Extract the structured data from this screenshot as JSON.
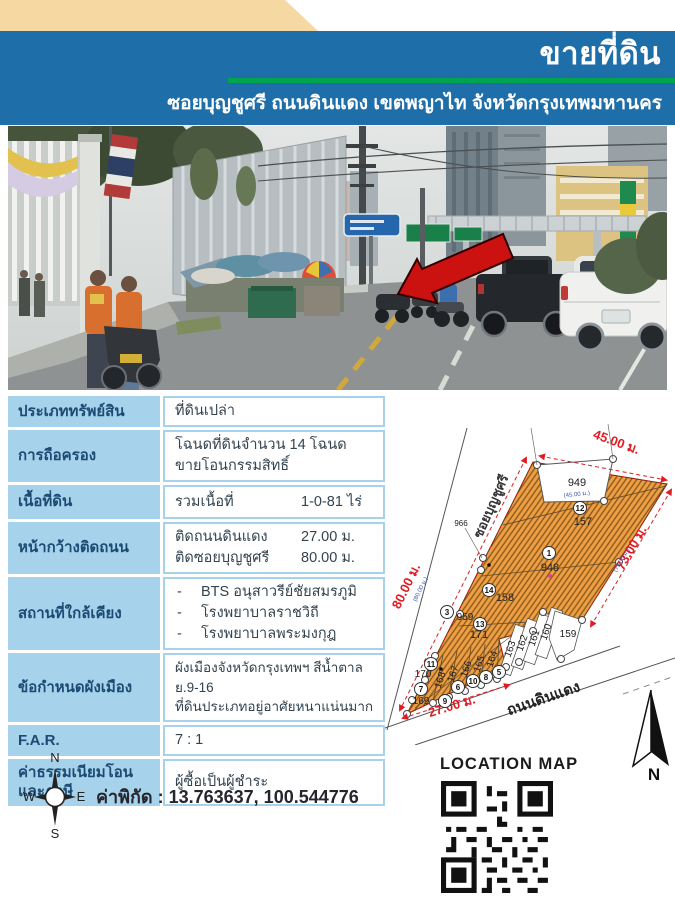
{
  "header": {
    "title": "ขายที่ดิน",
    "subtitle": "ซอยบุญชูศรี ถนนดินแดง เขตพญาไท จังหวัดกรุงเทพมหานคร"
  },
  "colors": {
    "header_blue": "#1e6ea9",
    "accent_green": "#00a44f",
    "corner_tan": "#f5d8a2",
    "table_blue": "#a7d2eb",
    "parcel_orange": "#ec9f44",
    "dimension_red": "#e01b22",
    "dimension_blue": "#3b54a5"
  },
  "table": {
    "rows": [
      {
        "label": "ประเภททรัพย์สิน",
        "value": "ที่ดินเปล่า"
      },
      {
        "label": "การถือครอง",
        "line1": "โฉนดที่ดินจำนวน 14 โฉนด",
        "line2": " ขายโอนกรรมสิทธิ์"
      },
      {
        "label": "เนื้อที่ดิน",
        "name": "รวมเนื้อที่",
        "value": "1-0-81 ไร่"
      },
      {
        "label": "หน้ากว้างติดถนน",
        "items": [
          {
            "name": "ติดถนนดินแดง",
            "value": "27.00 ม."
          },
          {
            "name": "ติดซอยบุญชูศรี",
            "value": "80.00 ม."
          }
        ]
      },
      {
        "label": "สถานที่ใกล้เคียง",
        "bullet": "-",
        "items": [
          "BTS อนุสาวรีย์ชัยสมรภูมิ",
          "โรงพยาบาลราชวิถี",
          "โรงพยาบาลพระมงกุฎ"
        ]
      },
      {
        "label": "ข้อกำหนดผังเมือง",
        "line1": "ผังเมืองจังหวัดกรุงเทพฯ  สีน้ำตาล ย.9-16",
        "line2": "ที่ดินประเภทอยู่อาศัยหนาแน่นมาก"
      },
      {
        "label": "F.A.R.",
        "value": "7 :  1"
      },
      {
        "label1": "ค่าธรรมเนียมโอน",
        "label2": "และภาษี",
        "value": "ผู้ซื้อเป็นผู้ชำระ"
      }
    ]
  },
  "map": {
    "dimensions": {
      "top": "45.00 ม.",
      "top_sub": "(45.00 ม.)",
      "left": "80.00 ม.",
      "left_sub": "(80.00 ม.)",
      "right": "73.00 ม.",
      "right_sub": "(73.00 ม.)",
      "bottom": "27.00 ม."
    },
    "roads": {
      "soi": "ซอยบุญชูศรี",
      "main": "ถนนดินแดง"
    },
    "parcels": {
      "p949": "949",
      "p157": "157",
      "p948": "948",
      "p158": "158",
      "p959": "959",
      "p171": "171",
      "p170": "170",
      "p169": "169",
      "p168": "168",
      "p167": "167",
      "p166": "166",
      "p165": "165",
      "p164": "164",
      "p163": "163",
      "p162": "162",
      "p161": "161",
      "p160": "160",
      "p159": "159",
      "p966": "966"
    },
    "circles": {
      "c1": "1",
      "c3": "3",
      "c5": "5",
      "c6": "6",
      "c7": "7",
      "c8": "8",
      "c9": "9",
      "c10": "10",
      "c11": "11",
      "c12": "12",
      "c13": "13",
      "c14": "14"
    },
    "north_label": "N"
  },
  "footer": {
    "coordinates": "ค่าพิกัด : 13.763637, 100.544776",
    "location_map_label": "LOCATION MAP",
    "compass": {
      "n": "N",
      "s": "S",
      "e": "E",
      "w": "W"
    }
  }
}
